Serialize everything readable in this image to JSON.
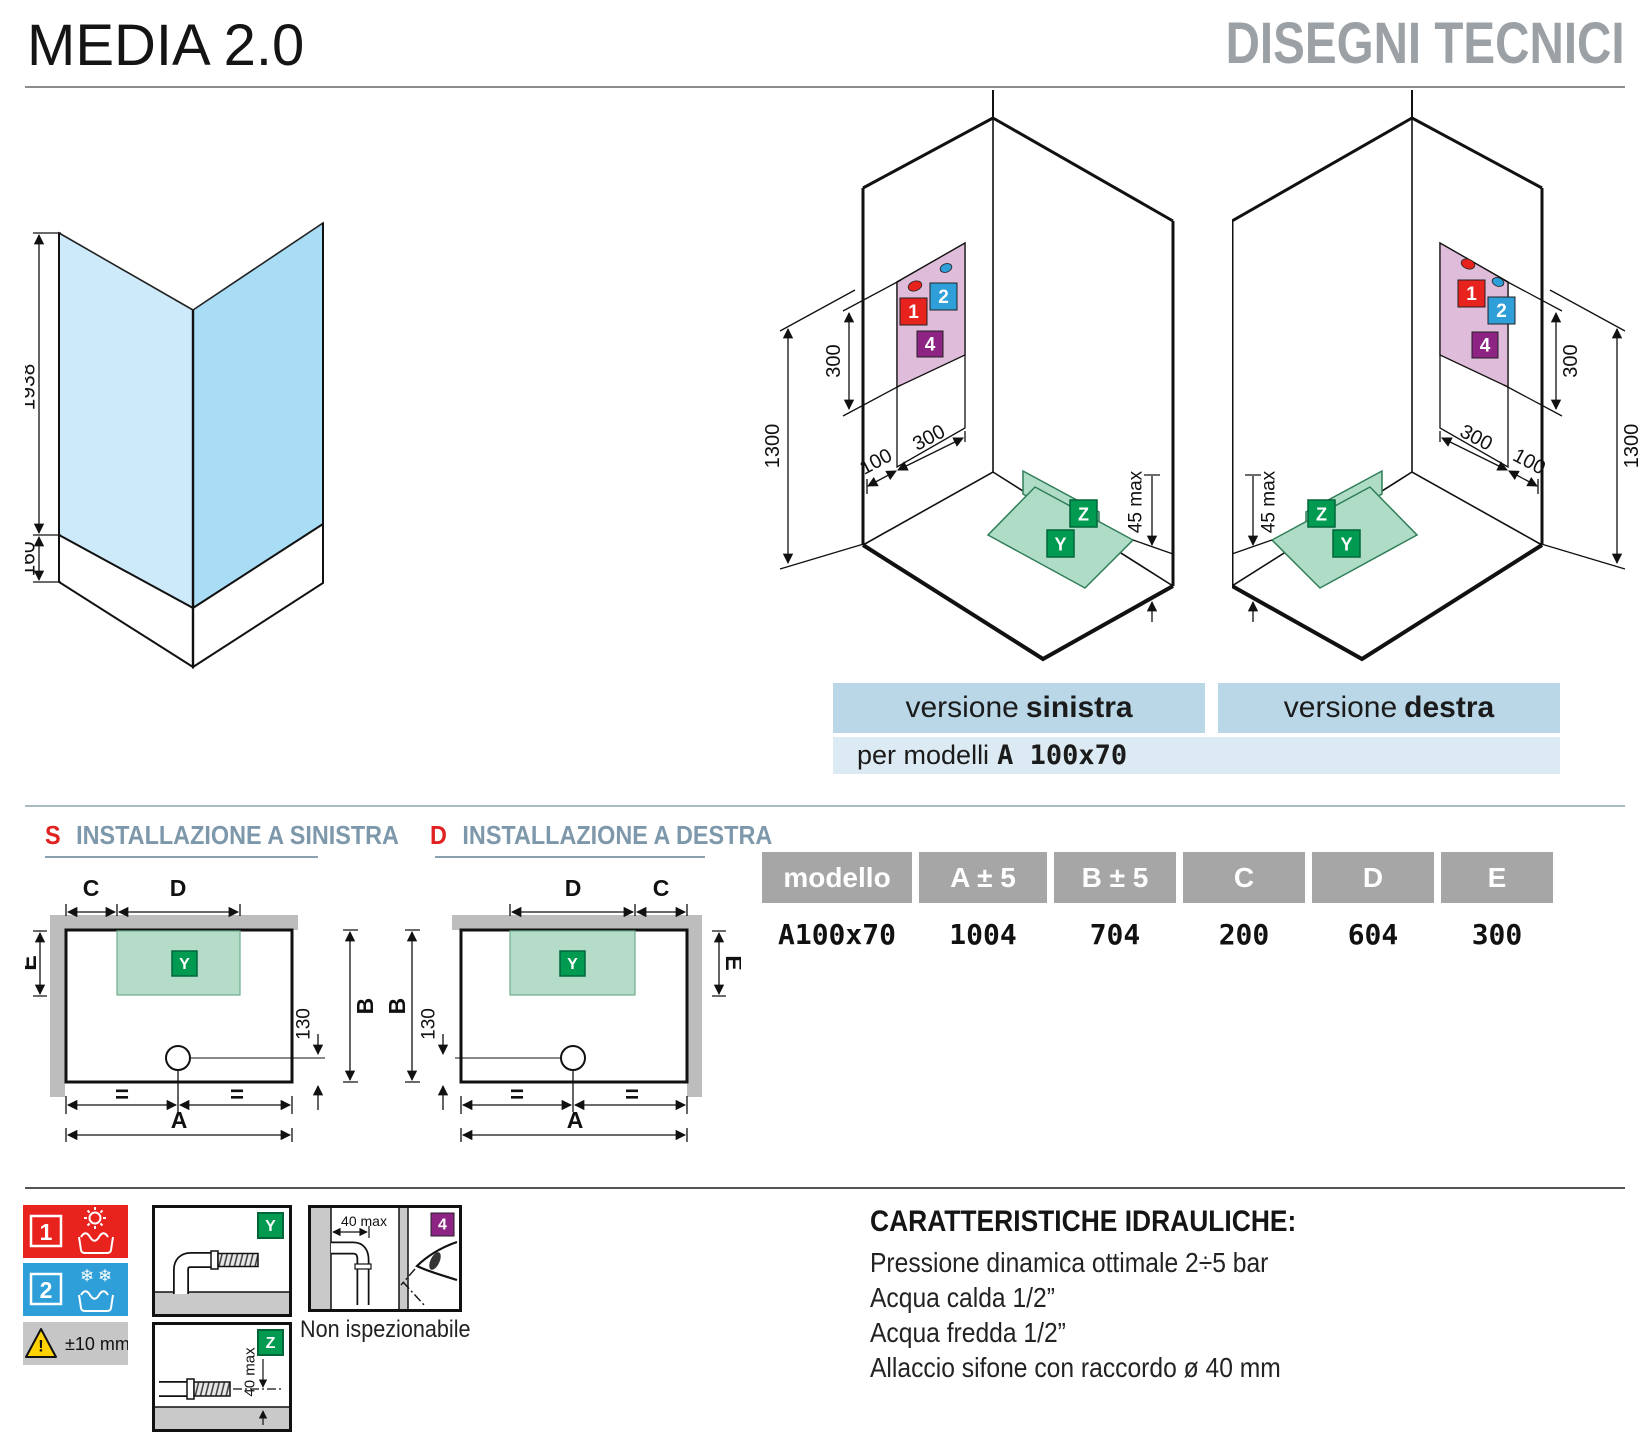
{
  "header": {
    "product": "MEDIA 2.0",
    "section": "DISEGNI TECNICI"
  },
  "glass_drawing": {
    "height": "1938",
    "base_height": "160"
  },
  "iso": {
    "dim_vertical_300": "300",
    "dim_1300": "1300",
    "dim_100": "100",
    "dim_slant_300": "300",
    "dim_45max": "45 max",
    "marker_1": "1",
    "marker_2": "2",
    "marker_4": "4",
    "marker_y": "Y",
    "marker_z": "Z"
  },
  "versions": {
    "left_label_normal": "versione",
    "left_label_bold": "sinistra",
    "right_label_normal": "versione",
    "right_label_bold": "destra",
    "models_normal": "per modelli",
    "models_bold": "A 100x70"
  },
  "plans": {
    "left_letter": "S",
    "left_title": "INSTALLAZIONE A SINISTRA",
    "right_letter": "D",
    "right_title": "INSTALLAZIONE A DESTRA",
    "dim_a": "A",
    "dim_b": "B",
    "dim_c": "C",
    "dim_d": "D",
    "dim_e": "E",
    "dim_130": "130",
    "equal_mark": "=",
    "marker_y": "Y"
  },
  "table": {
    "headers": [
      "modello",
      "A ± 5",
      "B ± 5",
      "C",
      "D",
      "E"
    ],
    "rows": [
      [
        "A100x70",
        "1004",
        "704",
        "200",
        "604",
        "300"
      ]
    ]
  },
  "legend": {
    "hot_number": "1",
    "cold_number": "2",
    "tolerance": "±10 mm",
    "y_label": "Y",
    "z_label": "Z",
    "z_dim": "40 max",
    "inspection_dim": "40 max",
    "inspection_number": "4",
    "inspection_caption": "Non ispezionabile"
  },
  "hydraulics": {
    "title": "CARATTERISTICHE IDRAULICHE:",
    "lines": [
      "Pressione dinamica ottimale 2÷5 bar",
      "Acqua calda 1/2”",
      "Acqua fredda 1/2”",
      "Allaccio sifone con raccordo ø 40 mm"
    ]
  },
  "colors": {
    "hot_red": "#e8231e",
    "cold_blue": "#2e9fd8",
    "hydro_purple": "#8d2484",
    "marker_green": "#009b51",
    "panel_pink": "#dfbcd9",
    "tray_green": "#afdcc6",
    "band_blue": "#bad7e8",
    "band_light": "#dcebf3",
    "table_header": "#a6a6a6",
    "glass_light": "#cdeafa",
    "glass_dark": "#a9ddf6",
    "warning_yellow": "#ffd200"
  }
}
